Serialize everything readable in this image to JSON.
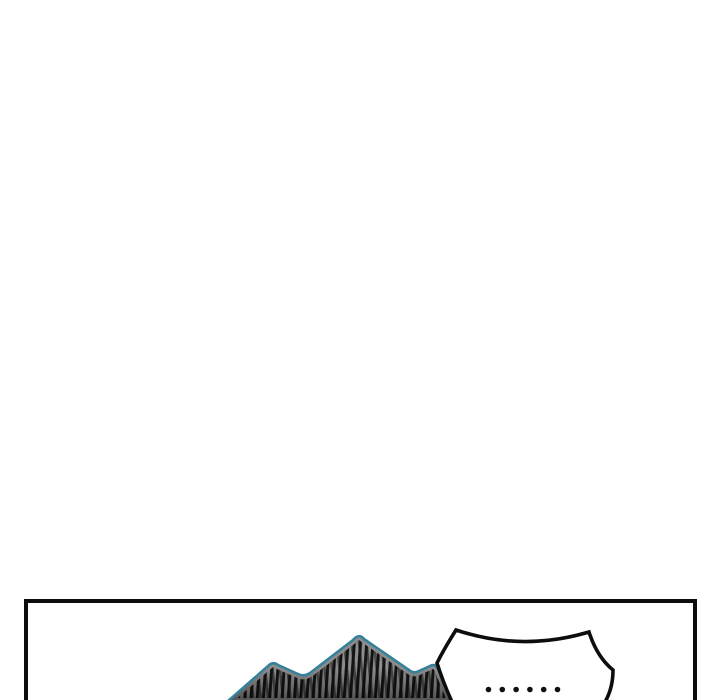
{
  "page": {
    "background_color": "#ffffff"
  },
  "panel": {
    "border_color": "#0d0d0d",
    "background_color": "#ffffff"
  },
  "speech_bubble": {
    "text": "......",
    "dot_count": 6,
    "fill_color": "#ffffff",
    "stroke_color": "#0d0d0d",
    "dot_color": "#101010"
  },
  "character_hair": {
    "outline_color": "#35809a",
    "base_color": "#8c8c8c",
    "strand_color": "#131313"
  }
}
